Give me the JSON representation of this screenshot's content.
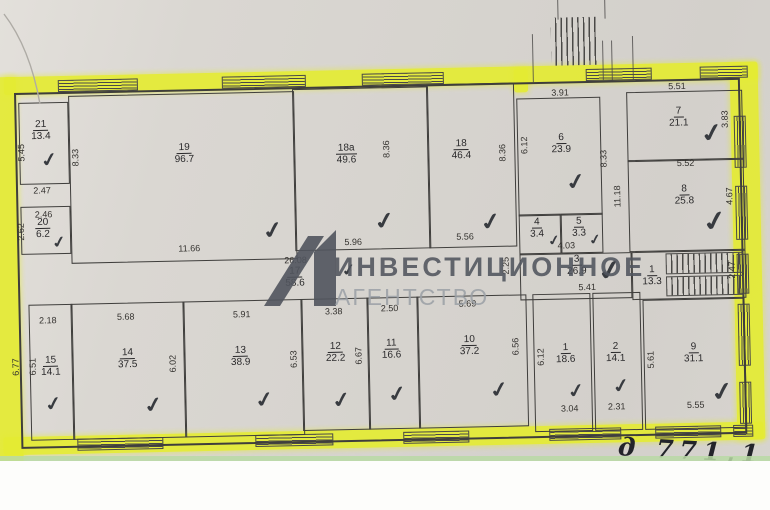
{
  "watermark": {
    "line1": "ИНВЕСТИЦИОННОЕ",
    "line2": "АГЕНТСТВО",
    "logo": "angular-agency-logo-mark"
  },
  "handwriting": {
    "text": "д 771,1"
  },
  "colors": {
    "highlighter": "#e5ec33",
    "paper": "#d8d5d0",
    "wall": "#3f3e3c",
    "dim_text": "#34322f",
    "watermark_dark": "#51555e",
    "watermark_light": "#9ba0a6",
    "scan_edge_green": "#b9d9a4"
  },
  "rooms": [
    {
      "num": "21",
      "area": "13.4",
      "rect": [
        4,
        10,
        48,
        80
      ],
      "label": [
        26,
        38
      ],
      "check": [
        34,
        68,
        18
      ]
    },
    {
      "num": "20",
      "area": "6.2",
      "rect": [
        4,
        114,
        48,
        46
      ],
      "label": [
        26,
        136
      ],
      "check": [
        42,
        150,
        15
      ]
    },
    {
      "num": "19",
      "area": "96.7",
      "rect": [
        54,
        4,
        224,
        166
      ],
      "label": [
        169,
        64
      ],
      "check": [
        256,
        143,
        22
      ]
    },
    {
      "num": "18a",
      "area": "49.6",
      "rect": [
        278,
        2,
        134,
        160
      ],
      "label": [
        331,
        68
      ],
      "check": [
        368,
        136,
        22
      ]
    },
    {
      "num": "18",
      "area": "46.4",
      "rect": [
        412,
        0,
        86,
        162
      ],
      "label": [
        446,
        66
      ],
      "check": [
        474,
        139,
        22
      ]
    },
    {
      "num": "6",
      "area": "23.9",
      "rect": [
        502,
        16,
        82,
        116
      ],
      "label": [
        546,
        62
      ],
      "check": [
        560,
        101,
        21
      ]
    },
    {
      "num": "4",
      "area": "3.4",
      "rect": [
        502,
        132,
        40,
        38
      ],
      "label": [
        520,
        146
      ],
      "check": [
        537,
        159,
        13
      ]
    },
    {
      "num": "5",
      "area": "3.3",
      "rect": [
        544,
        132,
        40,
        38
      ],
      "label": [
        562,
        146
      ],
      "check": [
        578,
        159,
        13
      ]
    },
    {
      "num": "7",
      "area": "21.1",
      "rect": [
        612,
        12,
        114,
        68
      ],
      "label": [
        664,
        38
      ],
      "check": [
        697,
        55,
        24
      ]
    },
    {
      "num": "8",
      "area": "25.8",
      "rect": [
        612,
        80,
        114,
        90
      ],
      "label": [
        668,
        116
      ],
      "check": [
        698,
        143,
        26
      ]
    },
    {
      "num": "17",
      "area": "58.6",
      "label": [
        277,
        190
      ],
      "check": [
        331,
        184,
        15
      ]
    },
    {
      "num": "3",
      "area": "26.9",
      "rect": [
        502,
        172,
        110,
        44
      ],
      "label": [
        559,
        184
      ],
      "check": [
        592,
        190,
        26
      ]
    },
    {
      "num": "1",
      "area": "13.3",
      "rect": [
        614,
        172,
        112,
        46
      ],
      "label": [
        634,
        196
      ],
      "stairs": true
    },
    {
      "num": "15",
      "area": "14.1",
      "rect": [
        10,
        212,
        42,
        134
      ],
      "label": [
        31,
        274
      ],
      "check": [
        33,
        312,
        18
      ]
    },
    {
      "num": "14",
      "area": "37.5",
      "rect": [
        52,
        212,
        112,
        134
      ],
      "label": [
        108,
        268
      ],
      "check": [
        133,
        315,
        20
      ]
    },
    {
      "num": "13",
      "area": "38.9",
      "rect": [
        164,
        212,
        118,
        134
      ],
      "label": [
        221,
        268
      ],
      "check": [
        244,
        312,
        20
      ]
    },
    {
      "num": "12",
      "area": "22.2",
      "rect": [
        282,
        212,
        66,
        130
      ],
      "label": [
        316,
        266
      ],
      "check": [
        321,
        314,
        20
      ]
    },
    {
      "num": "11",
      "area": "16.6",
      "rect": [
        348,
        212,
        50,
        130
      ],
      "label": [
        372,
        264
      ],
      "check": [
        377,
        309,
        20
      ]
    },
    {
      "num": "10",
      "area": "37.2",
      "rect": [
        398,
        212,
        108,
        130
      ],
      "label": [
        450,
        262
      ],
      "check": [
        479,
        307,
        20
      ]
    },
    {
      "num": "1",
      "area": "18.6",
      "rect": [
        514,
        212,
        56,
        136
      ],
      "label": [
        546,
        272
      ],
      "check": [
        556,
        310,
        18
      ]
    },
    {
      "num": "2",
      "area": "14.1",
      "rect": [
        574,
        212,
        46,
        136
      ],
      "label": [
        596,
        272
      ],
      "check": [
        601,
        306,
        18
      ]
    },
    {
      "num": "9",
      "area": "31.1",
      "rect": [
        624,
        220,
        100,
        128
      ],
      "label": [
        674,
        274
      ],
      "check": [
        702,
        314,
        24
      ]
    }
  ],
  "dimensions": [
    {
      "text": "5.45",
      "x": 6,
      "y": 60,
      "vertical": true
    },
    {
      "text": "8.33",
      "x": 60,
      "y": 66,
      "vertical": true
    },
    {
      "text": "2.47",
      "x": 26,
      "y": 98,
      "vertical": false
    },
    {
      "text": "2.46",
      "x": 27,
      "y": 122,
      "vertical": false
    },
    {
      "text": "2.62",
      "x": 4,
      "y": 139,
      "vertical": true
    },
    {
      "text": "11.66",
      "x": 172,
      "y": 159,
      "vertical": false
    },
    {
      "text": "8.36",
      "x": 371,
      "y": 64,
      "vertical": true
    },
    {
      "text": "5.96",
      "x": 336,
      "y": 156,
      "vertical": false
    },
    {
      "text": "8.36",
      "x": 487,
      "y": 70,
      "vertical": true
    },
    {
      "text": "5.56",
      "x": 448,
      "y": 153,
      "vertical": false
    },
    {
      "text": "3.91",
      "x": 546,
      "y": 11,
      "vertical": false
    },
    {
      "text": "6.12",
      "x": 509,
      "y": 63,
      "vertical": true
    },
    {
      "text": "8.33",
      "x": 588,
      "y": 78,
      "vertical": true
    },
    {
      "text": "11.18",
      "x": 601,
      "y": 116,
      "vertical": true
    },
    {
      "text": "4.03",
      "x": 549,
      "y": 164,
      "vertical": false
    },
    {
      "text": "5.51",
      "x": 663,
      "y": 7,
      "vertical": false
    },
    {
      "text": "3.83",
      "x": 710,
      "y": 41,
      "vertical": true
    },
    {
      "text": "5.52",
      "x": 670,
      "y": 84,
      "vertical": false
    },
    {
      "text": "4.67",
      "x": 713,
      "y": 118,
      "vertical": true
    },
    {
      "text": "26.08",
      "x": 278,
      "y": 173,
      "vertical": false
    },
    {
      "text": "2.25",
      "x": 488,
      "y": 183,
      "vertical": true
    },
    {
      "text": "5.41",
      "x": 569,
      "y": 206,
      "vertical": false
    },
    {
      "text": "2.47",
      "x": 714,
      "y": 192,
      "vertical": true
    },
    {
      "text": "2.18",
      "x": 29,
      "y": 228,
      "vertical": false
    },
    {
      "text": "6.77",
      "x": -4,
      "y": 274,
      "vertical": true
    },
    {
      "text": "6.51",
      "x": 13,
      "y": 274,
      "vertical": true
    },
    {
      "text": "5.68",
      "x": 107,
      "y": 226,
      "vertical": false
    },
    {
      "text": "6.02",
      "x": 153,
      "y": 274,
      "vertical": true
    },
    {
      "text": "5.91",
      "x": 223,
      "y": 226,
      "vertical": false
    },
    {
      "text": "6.53",
      "x": 274,
      "y": 272,
      "vertical": true
    },
    {
      "text": "3.38",
      "x": 315,
      "y": 225,
      "vertical": false
    },
    {
      "text": "6.67",
      "x": 339,
      "y": 270,
      "vertical": true
    },
    {
      "text": "2.50",
      "x": 371,
      "y": 223,
      "vertical": false
    },
    {
      "text": "5.69",
      "x": 449,
      "y": 220,
      "vertical": false
    },
    {
      "text": "6.56",
      "x": 496,
      "y": 264,
      "vertical": true
    },
    {
      "text": "6.12",
      "x": 521,
      "y": 275,
      "vertical": true
    },
    {
      "text": "3.04",
      "x": 549,
      "y": 327,
      "vertical": false
    },
    {
      "text": "2.31",
      "x": 596,
      "y": 326,
      "vertical": false
    },
    {
      "text": "5.61",
      "x": 631,
      "y": 280,
      "vertical": true
    },
    {
      "text": "5.55",
      "x": 675,
      "y": 326,
      "vertical": false
    }
  ],
  "windows": {
    "top": [
      [
        44,
        78
      ],
      [
        208,
        82
      ],
      [
        348,
        80
      ],
      [
        572,
        64
      ],
      [
        686,
        46
      ]
    ],
    "bottom": [
      [
        56,
        84
      ],
      [
        234,
        76
      ],
      [
        382,
        64
      ],
      [
        528,
        70
      ],
      [
        634,
        64
      ],
      [
        712,
        18
      ]
    ],
    "right": [
      [
        38,
        50
      ],
      [
        108,
        52
      ],
      [
        176,
        38
      ],
      [
        226,
        60
      ],
      [
        304,
        40
      ]
    ]
  }
}
